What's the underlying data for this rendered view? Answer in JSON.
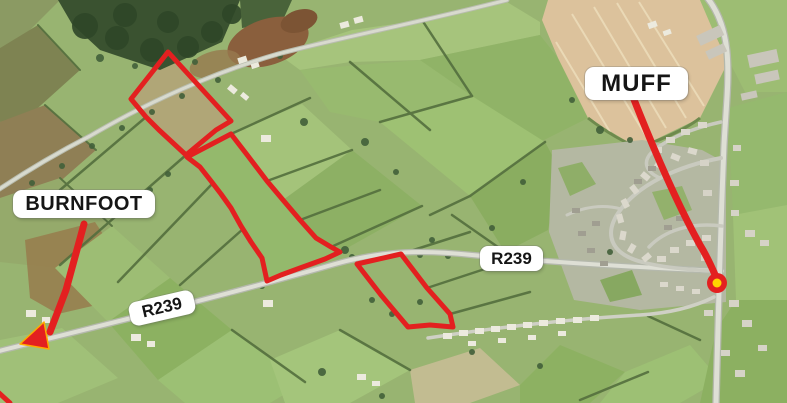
{
  "map": {
    "place_labels": [
      {
        "id": "burnfoot",
        "text": "BURNFOOT"
      },
      {
        "id": "muff",
        "text": "MUFF"
      }
    ],
    "road_labels": [
      {
        "id": "r239-west",
        "text": "R239"
      },
      {
        "id": "r239-east",
        "text": "R239"
      }
    ],
    "outlined_parcels_count": 3,
    "colors": {
      "annotation_red": "#e32020",
      "arrowhead_outline": "#ffaa00",
      "marker_yellow": "#ffd400",
      "label_background": "#ffffff",
      "label_text": "#151515"
    }
  }
}
